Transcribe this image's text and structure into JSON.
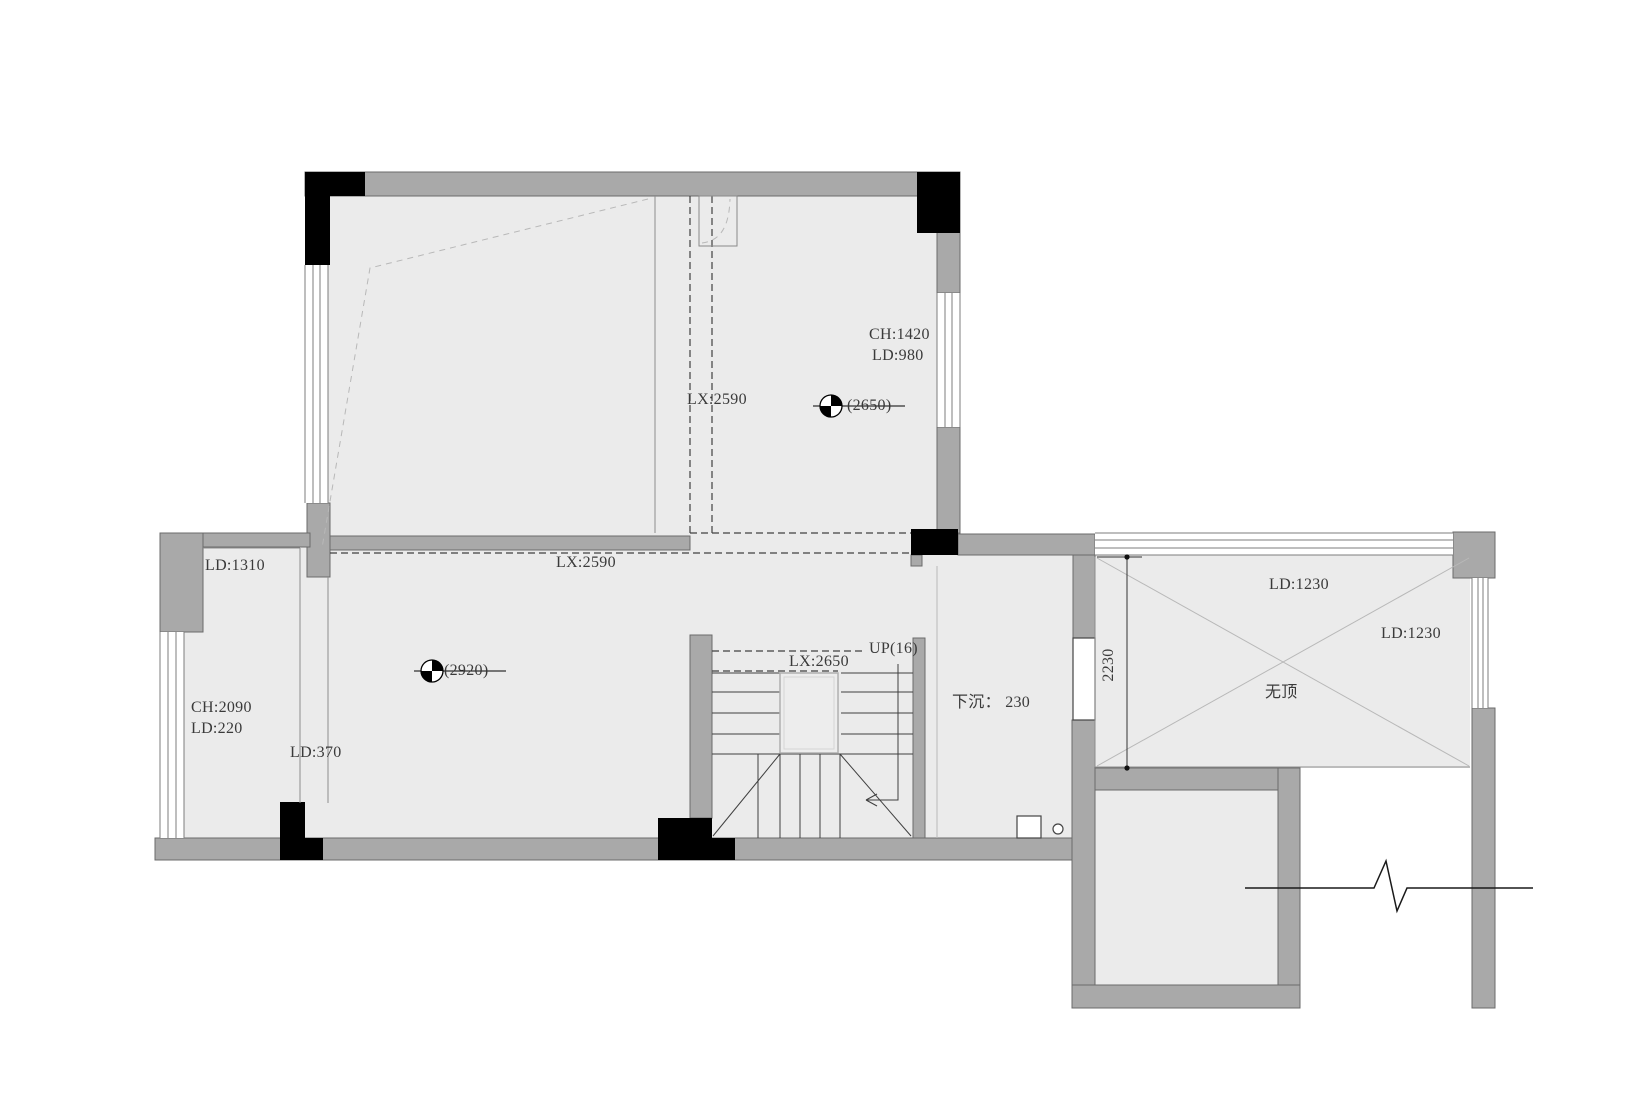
{
  "colors": {
    "background": "#ffffff",
    "floor": "#ebebeb",
    "wall": "#a9a9a9",
    "wall-stroke": "#6b6b6b",
    "column": "#000000",
    "line": "#8c8c8c",
    "dash": "#404040",
    "text": "#3a3a3a"
  },
  "annotations": {
    "upper_right_room": {
      "ceiling_height": "CH:1420",
      "ld": "LD:980",
      "elevation": "(2650)",
      "beam": "LX:2590"
    },
    "middle_beam": {
      "beam": "LX:2590"
    },
    "lower_left_room": {
      "ld_top": "LD:1310",
      "ceiling_height": "CH:2090",
      "ld": "LD:220",
      "ld_pier": "LD:370"
    },
    "lower_main_room": {
      "elevation": "(2920)"
    },
    "stairs": {
      "beam": "LX:2650",
      "direction": "UP(16)"
    },
    "sunken_area": {
      "note": "下沉： 230"
    },
    "terrace": {
      "dimension": "2230",
      "ld_top": "LD:1230",
      "ld_right": "LD:1230",
      "no_roof_note": "无顶"
    }
  }
}
